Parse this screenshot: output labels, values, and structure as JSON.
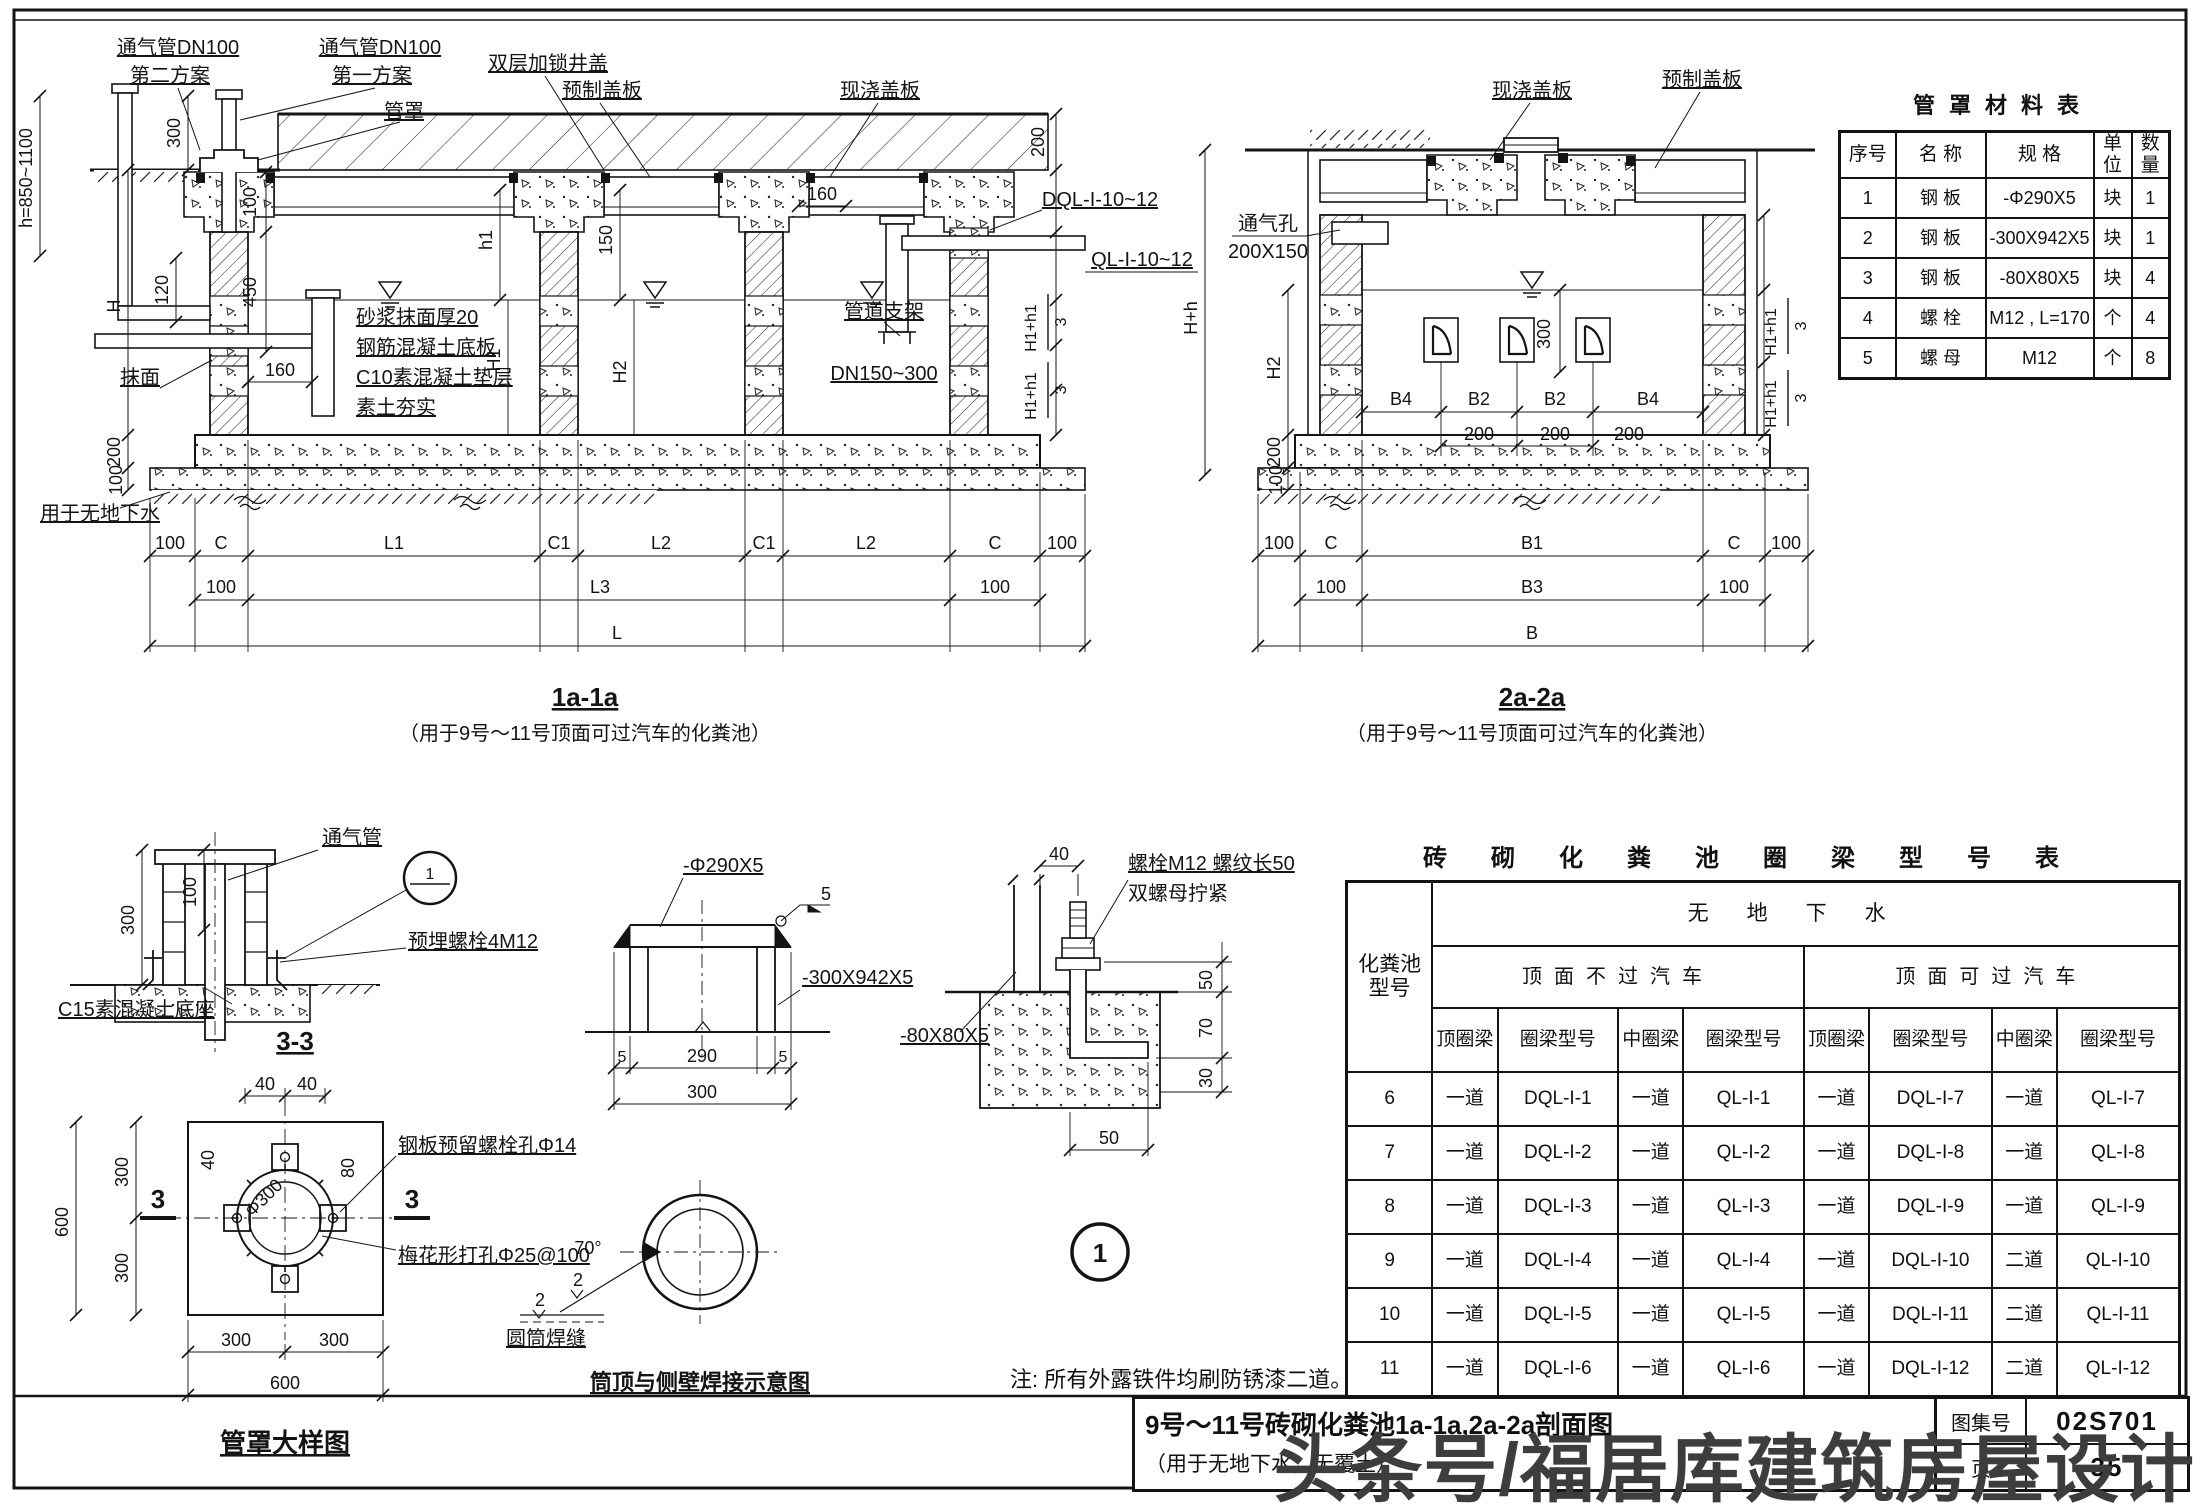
{
  "page": {
    "note": "注: 所有外露铁件均刷防锈漆二道。",
    "watermark": "头条号/福居库建筑房屋设计",
    "line_color": "#141414",
    "bg_color": "#ffffff"
  },
  "titleblock": {
    "title": "9号～11号砖砌化粪池1a-1a,2a-2a剖面图",
    "subtitle": "（用于无地下水，无覆土）",
    "atlas_label": "图集号",
    "atlas_no": "02S701",
    "page_label": "页",
    "page_no": "35"
  },
  "materials": {
    "title": "管罩材料表",
    "headers": [
      "序号",
      "名  称",
      "规  格",
      "单位",
      "数量"
    ],
    "rows": [
      [
        "1",
        "钢 板",
        "-Φ290X5",
        "块",
        "1"
      ],
      [
        "2",
        "钢 板",
        "-300X942X5",
        "块",
        "1"
      ],
      [
        "3",
        "钢 板",
        "-80X80X5",
        "块",
        "4"
      ],
      [
        "4",
        "螺 栓",
        "M12 , L=170",
        "个",
        "4"
      ],
      [
        "5",
        "螺 母",
        "M12",
        "个",
        "8"
      ]
    ]
  },
  "beams": {
    "title": "砖砌化粪池圈梁型号表",
    "h_type1": "化粪池",
    "h_type2": "型号",
    "h_nogw": "无地下水",
    "h_nocar": "顶面不过汽车",
    "h_car": "顶面可过汽车",
    "h_top": "顶圈梁",
    "h_model": "圈梁型号",
    "h_mid": "中圈梁",
    "rows": [
      [
        "6",
        "一道",
        "DQL-I-1",
        "一道",
        "QL-I-1",
        "一道",
        "DQL-I-7",
        "一道",
        "QL-I-7"
      ],
      [
        "7",
        "一道",
        "DQL-I-2",
        "一道",
        "QL-I-2",
        "一道",
        "DQL-I-8",
        "一道",
        "QL-I-8"
      ],
      [
        "8",
        "一道",
        "DQL-I-3",
        "一道",
        "QL-I-3",
        "一道",
        "DQL-I-9",
        "一道",
        "QL-I-9"
      ],
      [
        "9",
        "一道",
        "DQL-I-4",
        "一道",
        "QL-I-4",
        "一道",
        "DQL-I-10",
        "二道",
        "QL-I-10"
      ],
      [
        "10",
        "一道",
        "DQL-I-5",
        "一道",
        "QL-I-5",
        "一道",
        "DQL-I-11",
        "二道",
        "QL-I-11"
      ],
      [
        "11",
        "一道",
        "DQL-I-6",
        "一道",
        "QL-I-6",
        "一道",
        "DQL-I-12",
        "二道",
        "QL-I-12"
      ]
    ]
  },
  "s1": {
    "title": "1a-1a",
    "subtitle": "（用于9号～11号顶面可过汽车的化粪池）",
    "vent2a": "通气管DN100",
    "vent2b": "第二方案",
    "vent1a": "通气管DN100",
    "vent1b": "第一方案",
    "cover": "双层加锁井盖",
    "cap": "管罩",
    "precast": "预制盖板",
    "cast": "现浇盖板",
    "plaster": "抹面",
    "notes": [
      "砂浆抹面厚20",
      "钢筋混凝土底板",
      "C10素混凝土垫层",
      "素土夯实"
    ],
    "nogw": "用于无地下水",
    "support": "管道支架",
    "dn": "DN150~300",
    "dql": "DQL-I-10~12",
    "ql": "QL-I-10~12"
  },
  "s2": {
    "title": "2a-2a",
    "subtitle": "（用于9号～11号顶面可过汽车的化粪池）",
    "cast": "现浇盖板",
    "precast": "预制盖板",
    "vent1": "通气孔",
    "vent2": "200X150"
  },
  "d33": {
    "title": "3-3",
    "vent": "通气管",
    "bolt": "预埋螺栓4M12",
    "base": "C15素混凝土底座"
  },
  "plan": {
    "title": "管罩大样图",
    "hole": "钢板预留螺栓孔Φ14",
    "plum": "梅花形打孔Φ25@100"
  },
  "capd": {
    "plate1": "-Φ290X5",
    "plate2": "-300X942X5"
  },
  "weld": {
    "title": "筒顶与侧壁焊接示意图",
    "seam": "圆筒焊缝"
  },
  "boltd": {
    "l1": "螺栓M12 螺纹长50",
    "l2": "双螺母拧紧",
    "plate": "-80X80X5"
  },
  "dims": {
    "n2": "2",
    "n5": "5",
    "n30": "30",
    "n40": "40",
    "n50": "50",
    "n70": "70",
    "n80": "80",
    "n100": "100",
    "n120": "120",
    "n150": "150",
    "n160": "160",
    "n200": "200",
    "n290": "290",
    "n300": "300",
    "n450": "450",
    "n600": "600",
    "one": "1",
    "three": "3",
    "h": "h=850~1100",
    "H": "H",
    "h1": "h1",
    "H1": "H1",
    "H2": "H2",
    "Hh": "H+h",
    "fr": "H1+h1",
    "L": "L",
    "L1": "L1",
    "L2": "L2",
    "L3": "L3",
    "C": "C",
    "C1": "C1",
    "B": "B",
    "B1": "B1",
    "B2": "B2",
    "B3": "B3",
    "B4": "B4",
    "phi300": "Φ300",
    "deg70": "70°"
  }
}
